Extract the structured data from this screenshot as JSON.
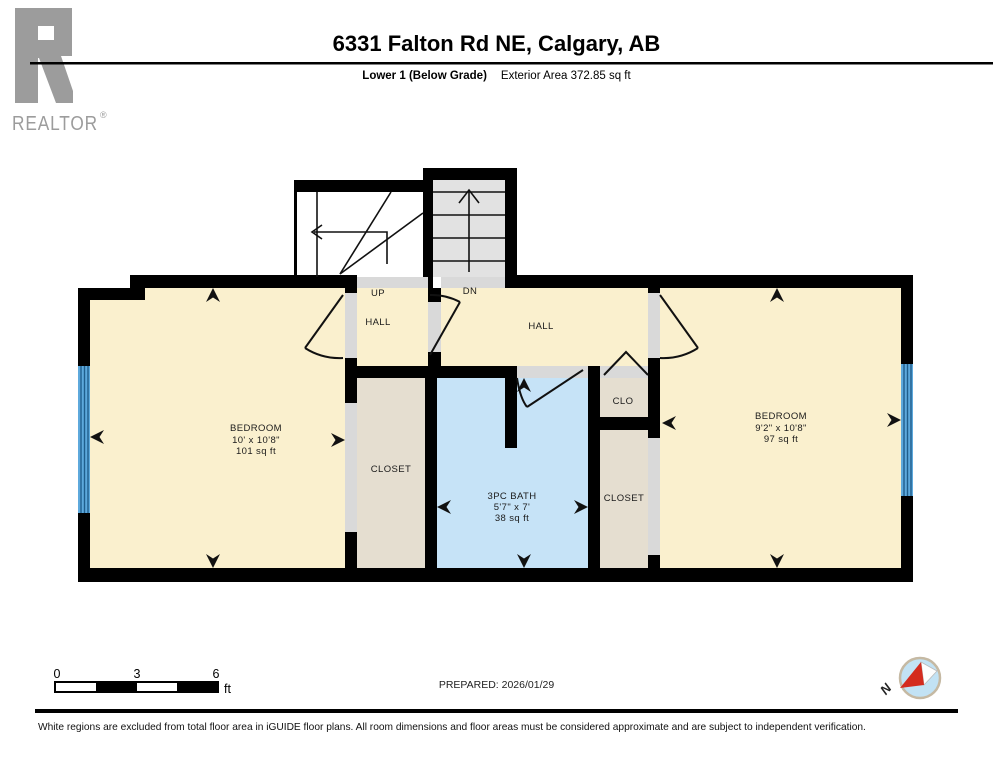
{
  "header": {
    "logo": {
      "text": "REALTOR",
      "reg": "®"
    },
    "title": "6331 Falton Rd NE, Calgary, AB",
    "floor_label": "Lower 1 (Below Grade)",
    "area_label": "Exterior Area 372.85 sq ft"
  },
  "plan": {
    "stairs": {
      "up_label": "UP",
      "dn_label": "DN"
    },
    "rooms": {
      "bedroom_left": {
        "name": "BEDROOM",
        "dims": "10' x 10'8\"",
        "area": "101 sq ft"
      },
      "bedroom_right": {
        "name": "BEDROOM",
        "dims": "9'2\" x 10'8\"",
        "area": "97 sq ft"
      },
      "bath": {
        "name": "3PC BATH",
        "dims": "5'7\" x 7'",
        "area": "38 sq ft"
      },
      "hall_left": "HALL",
      "hall_right": "HALL",
      "closet_left": "CLOSET",
      "closet_right": "CLOSET",
      "clo": "CLO"
    }
  },
  "scale_bar": {
    "tick_0": "0",
    "tick_3": "3",
    "tick_6": "6",
    "unit": "ft"
  },
  "prepared_label": "PREPARED: 2026/01/29",
  "compass": {
    "north_label": "N"
  },
  "footer_note": "White regions are excluded from total floor area in iGUIDE floor plans. All room dimensions and floor areas must be considered approximate and are subject to independent verification.",
  "colors": {
    "room_fill": "#FAF0CE",
    "closet_fill": "#E5DED0",
    "bath_fill": "#C6E3F7",
    "stair_fill": "#E2E2E2",
    "opening_fill": "#D9D9D9",
    "window_blue": "#5EA9DC",
    "window_line": "#1F5E8C",
    "wall": "#000000",
    "logo_gray": "#9C9C9C",
    "compass_red": "#D42B1E"
  }
}
